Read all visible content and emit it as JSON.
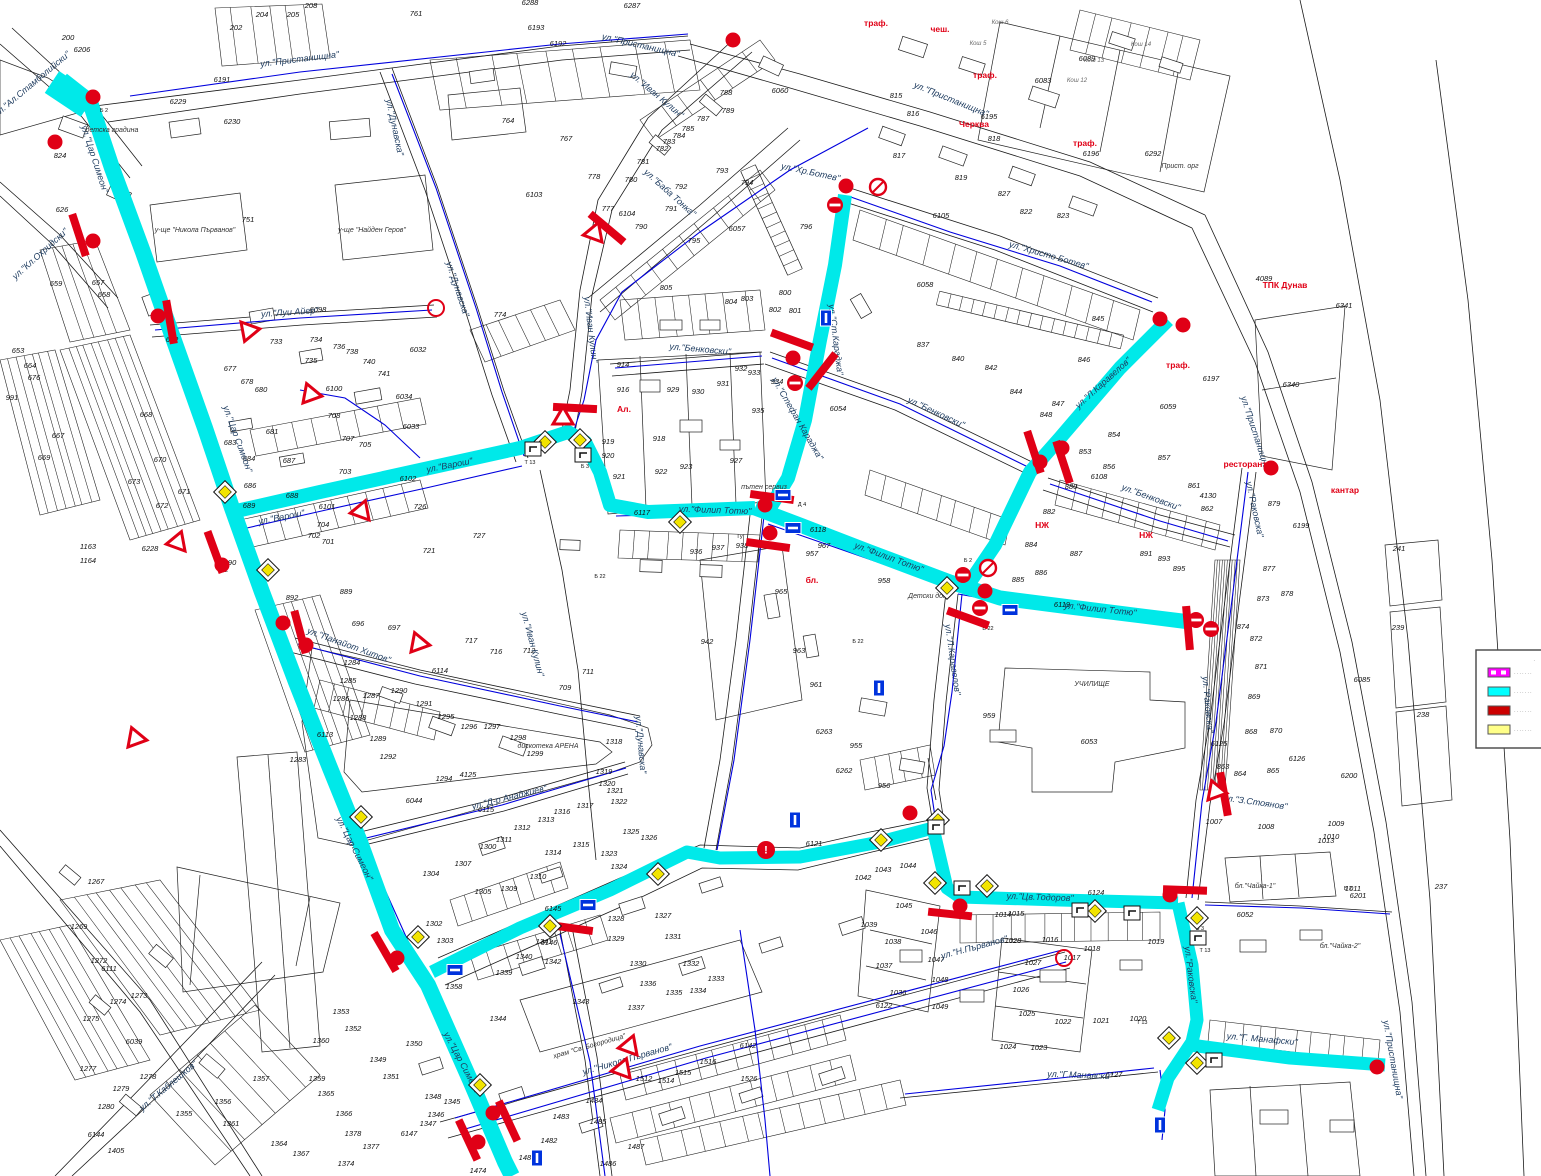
{
  "map": {
    "street_labels": [
      "ул.\"Ал.Стамболийски\"|34|86|-40",
      "ул.\"Кл.Охридски\"|42|256|-42",
      "ул.\"Пристанищна\"|300|62|-7",
      "ул.\"Пристанищна\"|640|48|13",
      "ул.\"Пристанищна\"|950|102|22",
      "ул.\"Пристанищна\"|1253|435|72",
      "ул.\"Пристанищна\"|1390|1060|80",
      "ул.\"Цар Симеон\"|92|160|72",
      "ул.\"Цар Симеон\"|235|440|70",
      "ул.\"Цар Симеон\"|352|850|63",
      "ул.\"Цар Симеон\"|460|1065|62",
      "ул.\"Луи Айер\"|290|315|-4",
      "ул.\"Варош\"|282|520|-11",
      "ул.\"Варош\"|450|468|-11",
      "ул.\"Иван Кулин\"|588|330|83",
      "ул.\"Иван Кулин\"|655|97|40",
      "ул.\"Иван Кулин\"|530|645|75",
      "ул.\"Баба Тонка\"|668|195|42",
      "ул.\"Дунавска\"|392|128|78",
      "ул.\"Дунавска\"|455|290|72",
      "ул.\"Дунавска\"|638|745|85",
      "ул.\"Хр.Ботев\"|810|175|12",
      "ул.\"Христо Ботев\"|1048|258|16",
      "ул.\"Ст.Караджа\"|833|340|83",
      "ул.\"Стефан Караджа\"|795|420|60",
      "ул.\"Бенковски\"|700|352|5",
      "ул.\"Бенковски\"|935|415|25",
      "ул.\"Бенковски\"|1150|500|20",
      "ул.\"Филип Тотю\"|715|513|2",
      "ул.\"Филип Тотю\"|888|560|20",
      "ул.\"Филип Тотю\"|1100|612|6",
      "ул.\"Л.Каравелов\"|1105|385|-42",
      "ул.\"Л.Каравелов\"|950|660|82",
      "ул.\"Раковска\"|1252|510|78",
      "ул.\"Раковска\"|1205|705|85",
      "ул.\"Раковска\"|1188|975|83",
      "ул.\"Цв.Тодоров\"|1040|900|2",
      "ул.\"З.Стоянов\"|1255|805|8",
      "ул.\"Г. Манафски\"|1262|1042|5",
      "ул.\"Г.Манавски\"|1080|1078|2",
      "ул.\"Н.Първанов\"|975|950|-15",
      "ул.\"Никола Първанов\"|628|1062|-16",
      "ул.\"Т.Каблешков\"|170|1088|-40",
      "ул.\"Панайот Хитов\"|348|648|20",
      "ул.\"Д-р Анаджиев\"|510|800|-14"
    ],
    "poi_labels": [
      "детска градина|112|132|0",
      "у-ще \"Никола Първанов\"|195|232|0",
      "у-ще \"Найден Геров\"|372|232|0",
      "дискотека АРЕНА|548|748|0",
      "УЧИЛИЩЕ|1092|686|0",
      "храм \"Св. Богородица\"|590|1048|-16",
      "пътен сервиз|764|489|0",
      "Детски дом|928|598|0",
      "Прист. орг|1180|168|0",
      "бл.\"Чайка-1\"|1255|888|0",
      "бл.\"Чайка-2\"|1340|948|0"
    ],
    "gray_labels": [
      "Кош 5|978|45",
      "Кош 6|1000|24",
      "Кош 12|1077|82",
      "Кош 13|1094|62",
      "Кош 14|1141|46"
    ],
    "red_labels": [
      "траф.|876|26",
      "чеш.|940|32",
      "траф.|985|78",
      "Черква|974|127",
      "траф.|1085|146",
      "траф.|1178|368",
      "ТПК Дунав|1285|288",
      "ресторант|1245|467",
      "кантар|1345|493",
      "НЖ|1042|528",
      "НЖ|1146|538",
      "бл.|812|583",
      "Ал.|624|412"
    ],
    "codes": [
      "Б 2|104|112",
      "Б 2|224|572",
      "Т 13|530|464",
      "Б 3|585|468",
      "Б 22|600|578",
      "Д 4|802|506",
      "Б 22|858|643",
      "Б 2|968|562",
      "Б 22|988|630",
      "Т 13|1205|952",
      "Б 2|1348|890",
      "Т 13|1142|1024",
      "Б 3|1200|930",
      "Гу|740|538"
    ],
    "numbers": [
      "6206|82|52",
      "6191|222|82",
      "6192|558|46",
      "6193|536|30",
      "200|68|40",
      "202|236|30",
      "204|262|17",
      "205|293|17",
      "208|311|8",
      "761|416|16",
      "6288|530|5",
      "6287|632|8",
      "6089|1087|61",
      "6083|1043|83",
      "6195|989|119",
      "6196|1091|156",
      "6292|1153|156",
      "815|896|98",
      "816|913|116",
      "817|899|158",
      "818|994|141",
      "819|961|180",
      "827|1004|196",
      "822|1026|214",
      "823|1063|218",
      "824|60|158",
      "6229|178|104",
      "6230|232|124",
      "751|248|222",
      "626|62|212",
      "657|98|285",
      "659|56|286",
      "658|104|297",
      "653|18|353",
      "676|34|380",
      "664|30|368",
      "991|12|400",
      "667|58|438",
      "669|44|460",
      "670|160|462",
      "671|184|494",
      "672|162|508",
      "673|134|484",
      "668|146|417",
      "6228|150|551",
      "1163|88|549",
      "1164|88|563",
      "652|172|342",
      "6098|318|312",
      "733|276|344",
      "734|316|342",
      "735|311|363",
      "736|339|349",
      "738|352|354",
      "740|369|364",
      "741|384|376",
      "6032|418|352",
      "6034|404|399",
      "6033|411|429",
      "6100|334|391",
      "708|334|418",
      "707|348|441",
      "705|365|447",
      "703|345|474",
      "704|323|527",
      "702|314|538",
      "701|328|544",
      "726|420|509",
      "727|479|538",
      "721|429|553",
      "6102|408|481",
      "6101|327|509",
      "677|230|371",
      "678|247|384",
      "680|261|392",
      "681|272|434",
      "683|230|445",
      "684|249|461",
      "686|250|488",
      "687|289|463",
      "688|292|498",
      "689|249|508",
      "890|230|565",
      "892|292|600",
      "889|346|594",
      "774|500|317",
      "764|508|123",
      "767|566|141",
      "777|608|211",
      "778|594|179",
      "780|631|182",
      "781|643|164",
      "782|662|151",
      "783|669|144",
      "784|679|138",
      "785|688|131",
      "787|703|121",
      "788|726|95",
      "789|728|113",
      "790|641|229",
      "791|671|211",
      "792|681|189",
      "793|722|173",
      "794|747|185",
      "795|694|243",
      "805|666|290",
      "6103|534|197",
      "6104|627|216",
      "6060|780|93",
      "6057|737|231",
      "6058|925|287",
      "796|806|229",
      "800|785|295",
      "801|795|313",
      "802|775|312",
      "803|747|301",
      "804|731|304",
      "931|723|386",
      "932|741|371",
      "933|754|375",
      "934|777|384",
      "935|758|413",
      "6054|838|411",
      "914|623|367",
      "916|623|392",
      "918|659|441",
      "919|608|444",
      "920|608|458",
      "921|619|479",
      "922|661|474",
      "923|686|469",
      "927|736|463",
      "929|673|392",
      "930|698|394",
      "936|696|554",
      "937|718|550",
      "938|742|548",
      "957|812|556",
      "958|884|583",
      "967|824|548",
      "965|781|594",
      "963|799|653",
      "961|816|687",
      "942|707|644",
      "955|856|748",
      "959|989|718",
      "6263|824|734",
      "6262|844|773",
      "956|884|788",
      "6117|642|515",
      "6118|818|532",
      "6119|1062|607",
      "6105|941|218",
      "6108|1099|479",
      "6121|814|846",
      "837|923|347",
      "840|958|361",
      "842|991|370",
      "844|1016|394",
      "845|1098|321",
      "846|1084|362",
      "847|1058|406",
      "848|1046|417",
      "853|1085|454",
      "854|1114|437",
      "856|1109|469",
      "857|1164|460",
      "861|1194|488",
      "862|1207|511",
      "4130|1208|498",
      "880|1071|489",
      "882|1049|514",
      "884|1031|547",
      "887|1076|556",
      "891|1146|556",
      "893|1164|561",
      "895|1179|571",
      "877|1269|571",
      "878|1287|596",
      "879|1274|506",
      "6199|1301|528",
      "6197|1211|381",
      "6340|1291|387",
      "6341|1344|308",
      "4089|1264|281",
      "6059|1168|409",
      "873|1263|601",
      "874|1243|629",
      "872|1256|641",
      "871|1261|669",
      "869|1254|699",
      "868|1251|734",
      "870|1276|733",
      "863|1223|769",
      "864|1240|776",
      "865|1273|773",
      "6125|1219|746",
      "6126|1297|761",
      "6200|1349|778",
      "6085|1362|682",
      "241|1399|551",
      "239|1398|630",
      "238|1423|717",
      "237|1441|889",
      "6053|1089|744",
      "6052|1245|917",
      "1013|1326|843",
      "1011|1353|891",
      "6201|1358|898",
      "1007|1214|824",
      "1008|1266|829",
      "1009|1336|826",
      "1010|1331|839",
      "1014|1003|917",
      "1015|1016|916",
      "1016|1050|942",
      "1017|1072|960",
      "1018|1092|951",
      "1019|1156|944",
      "1020|1138|1021",
      "1021|1101|1023",
      "1022|1063|1024",
      "1023|1039|1050",
      "1024|1008|1049",
      "1025|1027|1016",
      "1026|1021|992",
      "1027|1033|965",
      "1028|1013|943",
      "6124|1096|895",
      "6127|1114|1077",
      "1042|863|880",
      "1043|883|872",
      "1044|908|868",
      "1045|904|908",
      "1046|929|934",
      "1047|936|962",
      "1048|940|982",
      "1049|940|1009",
      "1039|869|927",
      "1038|893|944",
      "1037|884|968",
      "1036|898|995",
      "6122|884|1008",
      "1300|488|849",
      "1302|434|926",
      "1303|445|943",
      "1304|431|876",
      "1305|483|894",
      "1307|463|866",
      "1309|509|891",
      "1310|538|879",
      "1311|504|842",
      "1312|522|830",
      "1313|546|822",
      "1314|553|855",
      "1315|581|847",
      "1316|562|814",
      "1317|585|808",
      "1318|614|744",
      "1319|604|774",
      "1320|607|786",
      "1321|615|793",
      "1322|619|804",
      "1323|609|856",
      "1324|619|869",
      "1325|631|834",
      "1326|649|840",
      "1327|663|918",
      "1328|616|921",
      "1329|616|941",
      "1330|638|966",
      "1331|673|939",
      "1332|691|966",
      "1333|716|981",
      "1334|698|993",
      "1335|674|995",
      "1336|648|986",
      "1337|636|1010",
      "1339|504|975",
      "1340|524|959",
      "1341|544|944",
      "1342|553|964",
      "1343|581|1004",
      "1344|498|1021",
      "1358|454|989",
      "6145|553|911",
      "6146|549|945",
      "6142|748|1048",
      "1283|298|762",
      "1284|352|665",
      "1285|348|683",
      "1286|341|701",
      "1287|371|698",
      "1288|358|720",
      "1289|378|741",
      "1290|399|693",
      "1291|424|706",
      "1292|388|759",
      "1294|444|781",
      "1295|446|719",
      "1296|469|729",
      "1297|492|729",
      "1298|518|740",
      "1299|535|756",
      "6044|414|803",
      "4125|468|777",
      "696|358|626",
      "697|394|630",
      "717|471|643",
      "716|496|654",
      "712|529|653",
      "711|588|674",
      "709|565|690",
      "6115|486|812",
      "6114|440|673",
      "6113|325|737",
      "1267|96|884",
      "1269|79|929",
      "1272|99|963",
      "1273|139|998",
      "1274|118|1004",
      "1275|91|1021",
      "1277|88|1071",
      "1278|148|1079",
      "1279|121|1091",
      "1280|106|1109",
      "6144|96|1137",
      "1405|116|1153",
      "6111|109|971",
      "6039|134|1044",
      "1355|184|1116",
      "1356|223|1104",
      "1357|261|1081",
      "1359|317|1081",
      "1360|321|1043",
      "1361|231|1126",
      "1364|279|1146",
      "1367|301|1156",
      "1365|326|1096",
      "1366|344|1116",
      "1351|391|1079",
      "1352|353|1031",
      "1353|341|1014",
      "1374|346|1166",
      "1377|371|1149",
      "1378|353|1136",
      "6147|409|1136",
      "1350|414|1046",
      "1349|378|1062",
      "1348|433|1099",
      "1345|452|1104",
      "1346|436|1117",
      "1347|428|1126",
      "1474|478|1173",
      "1481|527|1160",
      "1482|549|1143",
      "1483|561|1119",
      "1484|594|1103",
      "1485|598|1124",
      "1486|608|1166",
      "1487|636|1149",
      "1512|644|1081",
      "1514|666|1083",
      "1515|683|1075",
      "1516|708|1064",
      "1526|749|1081",
      "885|1018|582",
      "886|1041|575"
    ],
    "symbols": {
      "dots": [
        [
          93,
          97
        ],
        [
          55,
          142
        ],
        [
          93,
          241
        ],
        [
          158,
          316
        ],
        [
          222,
          565
        ],
        [
          283,
          623
        ],
        [
          306,
          645
        ],
        [
          397,
          958
        ],
        [
          493,
          1113
        ],
        [
          478,
          1142
        ],
        [
          765,
          505
        ],
        [
          770,
          533
        ],
        [
          985,
          591
        ],
        [
          1040,
          462
        ],
        [
          1062,
          448
        ],
        [
          1160,
          319
        ],
        [
          1183,
          325
        ],
        [
          1271,
          468
        ],
        [
          1170,
          895
        ],
        [
          910,
          813
        ],
        [
          960,
          906
        ],
        [
          1377,
          1067
        ],
        [
          846,
          186
        ],
        [
          733,
          40
        ],
        [
          793,
          358
        ]
      ],
      "noentry": [
        [
          963,
          575
        ],
        [
          980,
          608
        ],
        [
          835,
          205
        ],
        [
          795,
          383
        ],
        [
          1196,
          620
        ],
        [
          1211,
          629
        ]
      ],
      "noslash": [
        [
          878,
          187
        ],
        [
          988,
          568
        ]
      ],
      "rings": [
        [
          436,
          308
        ],
        [
          1064,
          958
        ]
      ],
      "bars": [
        [
          79,
          235,
          72
        ],
        [
          170,
          322,
          80
        ],
        [
          215,
          552,
          70
        ],
        [
          300,
          632,
          75
        ],
        [
          385,
          952,
          60
        ],
        [
          468,
          1140,
          65
        ],
        [
          508,
          1121,
          65
        ],
        [
          571,
          928,
          8
        ],
        [
          575,
          408,
          3
        ],
        [
          607,
          228,
          40
        ],
        [
          772,
          497,
          8
        ],
        [
          768,
          545,
          8
        ],
        [
          792,
          340,
          20
        ],
        [
          822,
          371,
          -52
        ],
        [
          1034,
          452,
          72
        ],
        [
          1063,
          462,
          72
        ],
        [
          1185,
          890,
          2
        ],
        [
          950,
          914,
          6
        ],
        [
          1188,
          628,
          85
        ],
        [
          968,
          618,
          20
        ],
        [
          1224,
          794,
          80
        ]
      ],
      "giveway": [
        [
          248,
          332,
          20
        ],
        [
          310,
          393,
          160
        ],
        [
          362,
          510,
          200
        ],
        [
          563,
          417,
          180
        ],
        [
          595,
          232,
          200
        ],
        [
          418,
          642,
          160
        ],
        [
          630,
          1045,
          200
        ],
        [
          623,
          1068,
          200
        ],
        [
          1215,
          790,
          160
        ],
        [
          178,
          541,
          200
        ],
        [
          135,
          737,
          160
        ]
      ],
      "diamonds": [
        [
          225,
          492
        ],
        [
          268,
          570
        ],
        [
          545,
          442
        ],
        [
          580,
          440
        ],
        [
          680,
          522
        ],
        [
          947,
          588
        ],
        [
          361,
          817
        ],
        [
          418,
          937
        ],
        [
          550,
          926
        ],
        [
          658,
          874
        ],
        [
          480,
          1085
        ],
        [
          881,
          840
        ],
        [
          938,
          820
        ],
        [
          935,
          883
        ],
        [
          987,
          886
        ],
        [
          1095,
          911
        ],
        [
          1197,
          918
        ],
        [
          1169,
          1038
        ],
        [
          1197,
          1063
        ]
      ],
      "bluesigns": [
        [
          826,
          318,
          1
        ],
        [
          783,
          495,
          0
        ],
        [
          793,
          528,
          0
        ],
        [
          588,
          905,
          0
        ],
        [
          455,
          970,
          0
        ],
        [
          1010,
          610,
          0
        ],
        [
          537,
          1158,
          1
        ],
        [
          1160,
          1125,
          1
        ],
        [
          879,
          688,
          1
        ],
        [
          795,
          820,
          1
        ]
      ],
      "signboxes": [
        [
          533,
          449
        ],
        [
          583,
          455
        ],
        [
          936,
          827
        ],
        [
          962,
          888
        ],
        [
          1132,
          913
        ],
        [
          1198,
          938
        ],
        [
          1214,
          1060
        ],
        [
          1080,
          910
        ]
      ],
      "exclaims": [
        [
          766,
          850
        ]
      ]
    },
    "colors": {
      "highlight": "#00e9e9",
      "waterline": "#0000dd",
      "signal": "#e00016",
      "parcel_line": "#222222",
      "diamond_fill": "#f2e400",
      "bluesign_fill": "#0033dd"
    }
  },
  "legend": {
    "note": "·",
    "items": [
      {
        "color": "#ff00ff",
        "striped": true,
        "label": "·······"
      },
      {
        "color": "#00ffff",
        "striped": false,
        "label": "·······"
      },
      {
        "color": "#cc0000",
        "striped": false,
        "label": "·······"
      },
      {
        "color": "#ffff88",
        "striped": false,
        "label": "·······"
      }
    ]
  }
}
